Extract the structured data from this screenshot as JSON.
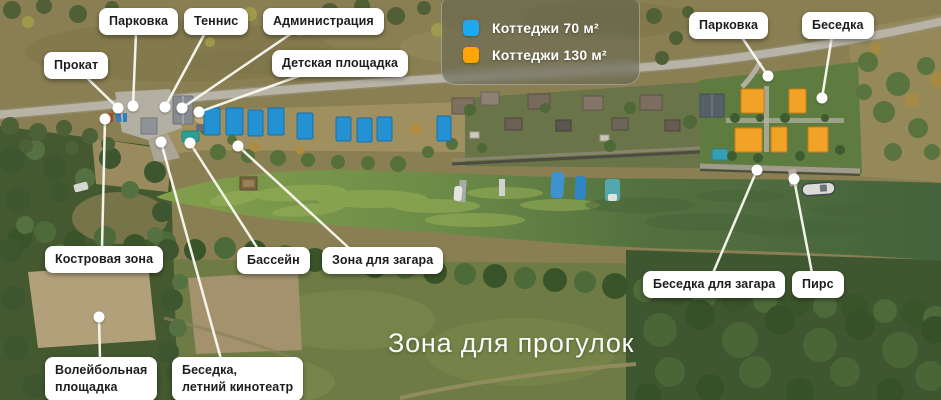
{
  "legend": {
    "items": [
      {
        "id": "cottage-70",
        "label": "Коттеджи 70 м²",
        "color": "#1da9f2"
      },
      {
        "id": "cottage-130",
        "label": "Коттеджи 130 м²",
        "color": "#ffa502"
      }
    ]
  },
  "area_label": "Зона для прогулок",
  "callouts": [
    {
      "id": "prokat",
      "label": "Прокат",
      "box": {
        "x": 44,
        "y": 52
      },
      "anchor": {
        "x": 88,
        "y": 79
      },
      "dot": {
        "x": 118,
        "y": 108
      }
    },
    {
      "id": "parkovka-left",
      "label": "Парковка",
      "box": {
        "x": 99,
        "y": 8
      },
      "anchor": {
        "x": 136,
        "y": 33
      },
      "dot": {
        "x": 133,
        "y": 106
      }
    },
    {
      "id": "tennis",
      "label": "Теннис",
      "box": {
        "x": 184,
        "y": 8
      },
      "anchor": {
        "x": 205,
        "y": 33
      },
      "dot": {
        "x": 165,
        "y": 107
      }
    },
    {
      "id": "administratsiya",
      "label": "Администрация",
      "box": {
        "x": 263,
        "y": 8
      },
      "anchor": {
        "x": 292,
        "y": 33
      },
      "dot": {
        "x": 182,
        "y": 108
      }
    },
    {
      "id": "detskaya-ploshchadka",
      "label": "Детская площадка",
      "box": {
        "x": 272,
        "y": 50
      },
      "anchor": {
        "x": 302,
        "y": 75
      },
      "dot": {
        "x": 199,
        "y": 112
      }
    },
    {
      "id": "kostrovaya-zona",
      "label": "Костровая зона",
      "box": {
        "x": 45,
        "y": 246
      },
      "anchor": {
        "x": 102,
        "y": 248
      },
      "dot": {
        "x": 105,
        "y": 119
      }
    },
    {
      "id": "bassein",
      "label": "Бассейн",
      "box": {
        "x": 237,
        "y": 247
      },
      "anchor": {
        "x": 258,
        "y": 249
      },
      "dot": {
        "x": 190,
        "y": 143
      }
    },
    {
      "id": "zona-dlya-zagara",
      "label": "Зона для загара",
      "box": {
        "x": 322,
        "y": 247
      },
      "anchor": {
        "x": 350,
        "y": 249
      },
      "dot": {
        "x": 238,
        "y": 146
      }
    },
    {
      "id": "voleybolnaya-ploshchadka",
      "label": "Волейбольная\nплощадка",
      "box": {
        "x": 45,
        "y": 357
      },
      "anchor": {
        "x": 100,
        "y": 359
      },
      "dot": {
        "x": 99,
        "y": 317
      }
    },
    {
      "id": "besedka-letniy-kinoteatr",
      "label": "Беседка,\nлетний кинотеатр",
      "box": {
        "x": 172,
        "y": 357
      },
      "anchor": {
        "x": 221,
        "y": 359
      },
      "dot": {
        "x": 161,
        "y": 142
      }
    },
    {
      "id": "parkovka-right",
      "label": "Парковка",
      "box": {
        "x": 689,
        "y": 12
      },
      "anchor": {
        "x": 741,
        "y": 36
      },
      "dot": {
        "x": 768,
        "y": 76
      }
    },
    {
      "id": "besedka-right",
      "label": "Беседка",
      "box": {
        "x": 802,
        "y": 12
      },
      "anchor": {
        "x": 832,
        "y": 36
      },
      "dot": {
        "x": 822,
        "y": 98
      }
    },
    {
      "id": "besedka-dlya-zagara",
      "label": "Беседка для загара",
      "box": {
        "x": 643,
        "y": 271
      },
      "anchor": {
        "x": 713,
        "y": 273
      },
      "dot": {
        "x": 757,
        "y": 170
      }
    },
    {
      "id": "pirs",
      "label": "Пирс",
      "box": {
        "x": 792,
        "y": 271
      },
      "anchor": {
        "x": 812,
        "y": 273
      },
      "dot": {
        "x": 794,
        "y": 179
      }
    }
  ],
  "map": {
    "color_70": "#2492d2",
    "color_70_edge": "#1b6fa8",
    "color_130": "#f2a227",
    "color_130_edge": "#c87f16",
    "cottages_70": [
      [
        204,
        108,
        16,
        27
      ],
      [
        226,
        108,
        17,
        27
      ],
      [
        248,
        110,
        15,
        26
      ],
      [
        268,
        108,
        16,
        27
      ],
      [
        297,
        113,
        16,
        26
      ],
      [
        336,
        117,
        15,
        24
      ],
      [
        357,
        118,
        15,
        24
      ],
      [
        377,
        117,
        15,
        24
      ],
      [
        437,
        116,
        14,
        25
      ]
    ],
    "cottages_130": [
      [
        741,
        89,
        23,
        24
      ],
      [
        789,
        89,
        17,
        24
      ],
      [
        735,
        128,
        27,
        24
      ],
      [
        771,
        127,
        16,
        25
      ],
      [
        808,
        127,
        20,
        25
      ]
    ]
  }
}
